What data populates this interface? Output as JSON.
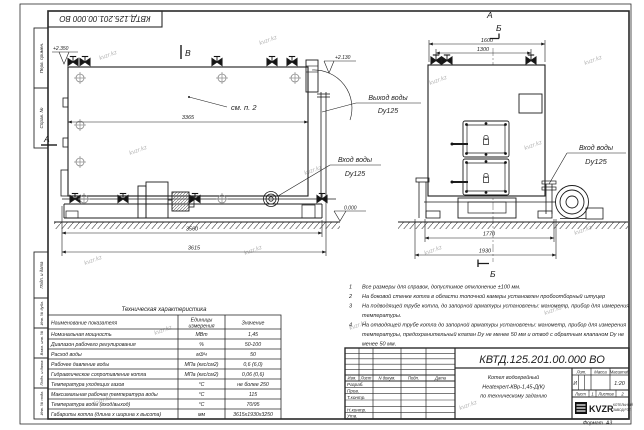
{
  "watermark": "kvzr.kz",
  "doc_number": "КВТД.125.201.00.000  ВО",
  "frame_labels": {
    "perv": "Перв. примен.",
    "sprav": "Справ. №",
    "podp1": "Подп. и дата",
    "inv_dubl": "Инв. № дубл.",
    "vzam": "Взам. инв. №",
    "podp2": "Подп. и дата",
    "inv_podl": "Инв. № подл."
  },
  "front_view": {
    "section_b": "В",
    "section_a": "А",
    "elev_top": "+2.350",
    "elev_outlet": "+2.130",
    "elev_zero": "0.000",
    "note_ref": "см. п. 2",
    "dim_body": "3365",
    "dim_skid": "3560",
    "dim_overall": "3615",
    "outlet_label": "Выход воды",
    "outlet_dn": "Dy125",
    "inlet_label": "Вход воды",
    "inlet_dn": "Dy125"
  },
  "end_view": {
    "label_a": "А",
    "label_b": "Б",
    "label_b2": "Б",
    "dim_overall": "1600",
    "dim_valves": "1300",
    "dim_frame": "1770",
    "dim_base": "1930",
    "inlet_label": "Вход воды",
    "inlet_dn": "Dy125"
  },
  "tech_table": {
    "title": "Техническая характеристика",
    "col1": "Наименование показателя",
    "col2a": "Единицы",
    "col2b": "измерения",
    "col3": "Значение",
    "rows": [
      [
        "Номинальная мощность",
        "МВт",
        "1,45"
      ],
      [
        "Диапазон рабочего регулирования",
        "%",
        "50-100"
      ],
      [
        "Расход воды",
        "м3/ч",
        "50"
      ],
      [
        "Рабочее давление воды",
        "МПа (кгс/см2)",
        "0,6 (6,0)"
      ],
      [
        "Гидравлическое сопротивление котла",
        "МПа (кгс/см2)",
        "0,06 (0,6)"
      ],
      [
        "Температура уходящих газов",
        "°С",
        "не более 250"
      ],
      [
        "Максимальная рабочая температура воды",
        "°С",
        "115"
      ],
      [
        "Температура воды (вход/выход)",
        "°С",
        "70/95"
      ],
      [
        "Габариты котла (длина х ширина х высота)",
        "мм",
        "3615х1930х3250"
      ]
    ]
  },
  "notes": [
    {
      "n": "1",
      "t": "Все размеры для справок, допустимое отклонение ±100 мм."
    },
    {
      "n": "2",
      "t": "На боковой стенке котла в области топочной камеры установлен пробоотборный штуцер"
    },
    {
      "n": "3",
      "t": "На  подводящей трубе котла, до запорной арматуры установлены: манометр, прибор для измерения"
    },
    {
      "n": "",
      "t": "температуры."
    },
    {
      "n": "4",
      "t": "На отводящей трубе котла до запорной арматуры установлены: манометр, прибор для измерения"
    },
    {
      "n": "",
      "t": "температуры, предохранительный клапан Dу не менее 50 мм и отвод с обратным клапаном Dу не"
    },
    {
      "n": "",
      "t": "менее 50 мм."
    }
  ],
  "title_block": {
    "cols": [
      "Изм.",
      "Лист",
      "N докум.",
      "Подп.",
      "Дата"
    ],
    "row_labels": [
      "Разраб.",
      "Пров.",
      "Т.контр.",
      "Н.контр.",
      "Утв."
    ],
    "name1": "Котел водогрейный",
    "name2": "Heatexpert-КВр-1,45-Д(К)",
    "name3": "по техническому заданию",
    "lit": "Лит.",
    "mass": "Масса",
    "scale": "Масштаб",
    "lit_val": "И",
    "scale_val": "1:20",
    "sheet": "Лист",
    "sheet_val": "1",
    "sheets": "Листов",
    "sheets_val": "2",
    "logo": "KVZR",
    "logo_sub1": "КОТЕЛЬНЫЙ",
    "logo_sub2": "ЗАВОД РЭП",
    "format": "Формат",
    "format_val": "А3"
  }
}
